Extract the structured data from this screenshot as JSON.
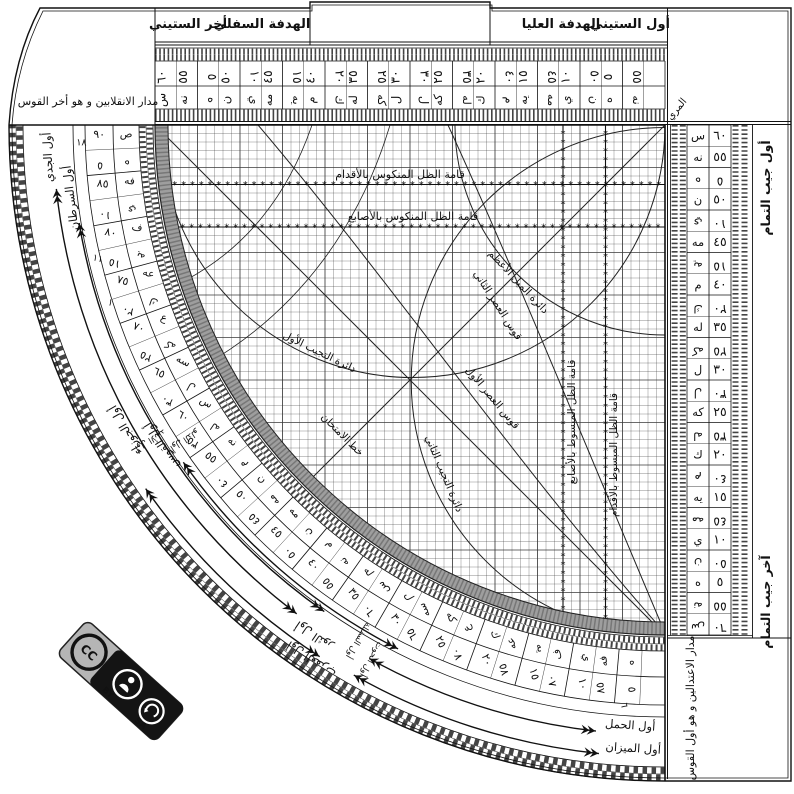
{
  "colors": {
    "ink": "#111111",
    "grid_line": "#3a3a3a",
    "band": "#9e9e9e",
    "badge_gray": "#b5b5b5",
    "badge_black": "#141414"
  },
  "title_strip": {
    "labels": [
      "أخر الستيني",
      "الهدفة السفلي",
      "الهدفة العليا",
      "أول الستيني"
    ]
  },
  "corner_boxes": {
    "top_left": "مدار الانقلابين و هو أخر القوس",
    "bottom_right": "مدار الاعتدالين و هو أول القوس",
    "muri": "المري"
  },
  "cosine_edge_labels": {
    "top": "أول جيب التمام",
    "bottom": "آخر جيب التمام"
  },
  "scales": {
    "sixty": {
      "main": [
        "٦٠",
        "٥٥",
        "٥٠",
        "٤٥",
        "٤٠",
        "٣٥",
        "٣٠",
        "٢٥",
        "٢٠",
        "١٥",
        "١٠",
        "٥"
      ],
      "main_abjad": [
        "س",
        "نه",
        "ن",
        "مه",
        "م",
        "له",
        "ل",
        "كه",
        "ك",
        "يه",
        "ي",
        "ه"
      ],
      "comp": [
        "٥",
        "١٠",
        "١٥",
        "٢٠",
        "٢٥",
        "٣٠",
        "٣٥",
        "٤٠",
        "٤٥",
        "٥٠",
        "٥٥"
      ],
      "comp_abjad": [
        "ه",
        "ي",
        "يه",
        "ك",
        "كه",
        "ل",
        "له",
        "م",
        "مه",
        "ن",
        "نه"
      ]
    },
    "cosine": {
      "main": [
        "٦٠",
        "٥٥",
        "٥٠",
        "٤٥",
        "٤٠",
        "٣٥",
        "٣٠",
        "٢٥",
        "٢٠",
        "١٥",
        "١٠",
        "٥"
      ],
      "main_abjad": [
        "س",
        "نه",
        "ن",
        "مه",
        "م",
        "له",
        "ل",
        "كه",
        "ك",
        "يه",
        "ي",
        "ه"
      ],
      "comp": [
        "٥",
        "١٠",
        "١٥",
        "٢٠",
        "٢٥",
        "٣٠",
        "٣٥",
        "٤٠",
        "٤٥",
        "٥٠",
        "٥٥",
        "٦٠"
      ],
      "comp_abjad": [
        "ه",
        "ي",
        "يه",
        "ك",
        "كه",
        "ل",
        "له",
        "م",
        "مه",
        "ن",
        "نه",
        "س"
      ]
    },
    "limb": {
      "main": [
        "٩٠",
        "٨٥",
        "٨٠",
        "٧٥",
        "٧٠",
        "٦٥",
        "٦٠",
        "٥٥",
        "٥٠",
        "٤٥",
        "٤٠",
        "٣٥",
        "٣٠",
        "٢٥",
        "٢٠",
        "١٥",
        "١٠",
        "٥"
      ],
      "main_abjad": [
        "ص",
        "فه",
        "ف",
        "عه",
        "ع",
        "سه",
        "س",
        "نه",
        "ن",
        "مه",
        "م",
        "له",
        "ل",
        "كه",
        "ك",
        "يه",
        "ي",
        "ه"
      ],
      "comp": [
        "٥",
        "١٠",
        "١٥",
        "٢٠",
        "٢٥",
        "٣٠",
        "٣٥",
        "٤٠",
        "٤٥",
        "٥٠",
        "٥٥",
        "٦٠",
        "٦٥",
        "٧٠",
        "٧٥",
        "٨٠",
        "٨٥"
      ],
      "comp_abjad": [
        "ه",
        "ي",
        "يه",
        "ك",
        "كه",
        "ل",
        "له",
        "م",
        "مه",
        "ن",
        "نه",
        "س",
        "سه",
        "ع",
        "عه",
        "ف",
        "فه"
      ]
    }
  },
  "grid_labels": [
    {
      "text": "قامة الظل المنكوس بالأقدام"
    },
    {
      "text": "قامة الظل المنكوس بالأصابع"
    },
    {
      "text": "دائرة الميل الأعظم"
    },
    {
      "text": "قوس العصر الثاني"
    },
    {
      "text": "دائرة التجيب الأول"
    },
    {
      "text": "قوس العصر الأول"
    },
    {
      "text": "خط الامتحان"
    },
    {
      "text": "دائرة التجيب الثاني"
    },
    {
      "text": "قامة الظل المبسوط بالأصابع"
    },
    {
      "text": "قامة الظل المبسوط بالأقدام"
    }
  ],
  "zodiac_labels": [
    {
      "text": "أول الجدي",
      "x": 51.8,
      "y": 157.1,
      "rot": 267,
      "size": 11.5
    },
    {
      "text": "أول السرطان",
      "x": 74.4,
      "y": 197.5,
      "rot": 263,
      "size": 11.5
    },
    {
      "text": "أول الجوزاء",
      "x": 128.9,
      "y": 428.3,
      "rot": 240.5,
      "size": 11.5
    },
    {
      "text": "أول القوس",
      "x": 164.9,
      "y": 443.6,
      "rot": 237.5,
      "size": 11.5
    },
    {
      "text": "أول الثور",
      "x": 316.1,
      "y": 632.7,
      "rot": 214.5,
      "size": 11.5
    },
    {
      "text": "أول العقرب",
      "x": 313.4,
      "y": 656.2,
      "rot": 213.5,
      "size": 11.5
    },
    {
      "text": "أول الحمل",
      "x": 630,
      "y": 729,
      "rot": 4,
      "size": 11.5
    },
    {
      "text": "أول الميزان",
      "x": 633,
      "y": 752,
      "rot": 3.5,
      "size": 11.5
    },
    {
      "text": "أول الأسد",
      "x": 149,
      "y": 438,
      "rot": 149,
      "size": 8.5
    },
    {
      "text": "أول الدلو",
      "x": 183,
      "y": 438,
      "rot": 147,
      "size": 8.5
    },
    {
      "text": "أول السنبلة",
      "x": 356,
      "y": 639,
      "rot": 121,
      "size": 8.5
    },
    {
      "text": "أول الحوت",
      "x": 369,
      "y": 658,
      "rot": 119,
      "size": 8.5
    }
  ],
  "limb_marks": [
    {
      "text": "١٨",
      "r": 584,
      "b": 88
    },
    {
      "text": "١١",
      "r": 584,
      "b": 76.5
    },
    {
      "text": "١",
      "r": 584,
      "b": 72
    },
    {
      "text": "٦",
      "r": 582,
      "b": 4.3
    }
  ],
  "arrows": [
    {
      "r": 612,
      "b1": 37,
      "b2": 84
    },
    {
      "r": 594,
      "b1": 35,
      "b2": 80.5
    },
    {
      "r": 588,
      "b1": 27,
      "b2": 55
    },
    {
      "r": 634,
      "b1": 33,
      "b2": 55
    },
    {
      "r": 610,
      "b1": 6.5,
      "b2": 29
    },
    {
      "r": 632,
      "b1": 6,
      "b2": 29.5
    }
  ],
  "license": {
    "cc": "CC",
    "by": "BY",
    "sa": "SA"
  }
}
